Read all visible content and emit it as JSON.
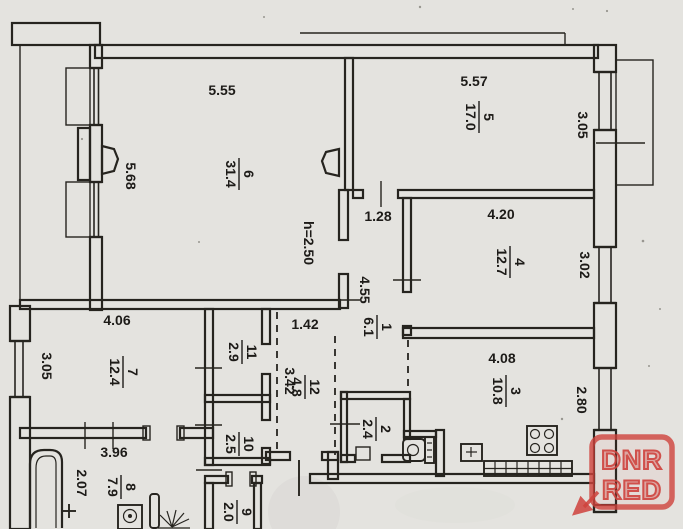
{
  "plan_title": "apartment-floor-plan",
  "height_note": "h=2.50",
  "rooms": {
    "r1": {
      "num": "1",
      "area": "6.1"
    },
    "r2": {
      "num": "2",
      "area": "2.4"
    },
    "r3": {
      "num": "3",
      "area": "10.8"
    },
    "r4": {
      "num": "4",
      "area": "12.7"
    },
    "r5": {
      "num": "5",
      "area": "17.0"
    },
    "r6": {
      "num": "6",
      "area": "31.4"
    },
    "r7": {
      "num": "7",
      "area": "12.4"
    },
    "r8": {
      "num": "8",
      "area": "7.9"
    },
    "r9": {
      "num": "9",
      "area": "2.0"
    },
    "r10": {
      "num": "10",
      "area": "2.5"
    },
    "r11": {
      "num": "11",
      "area": "2.9"
    },
    "r12": {
      "num": "12",
      "area": "4.8"
    }
  },
  "dims": {
    "room6_top": "5.55",
    "room6_left": "5.68",
    "room5_top": "5.57",
    "room5_right": "3.05",
    "room4_top": "4.20",
    "room4_right": "3.02",
    "room3_top": "4.08",
    "room3_right": "2.80",
    "room7_top": "4.06",
    "room7_left": "3.05",
    "room8_top": "3.96",
    "room8_left": "2.07",
    "hall_top": "1.28",
    "hall_side": "4.55",
    "corr_top": "1.42",
    "corr_side": "3.42"
  },
  "watermark": {
    "line1": "DNR",
    "line2": "RED",
    "color": "#cf423c"
  }
}
